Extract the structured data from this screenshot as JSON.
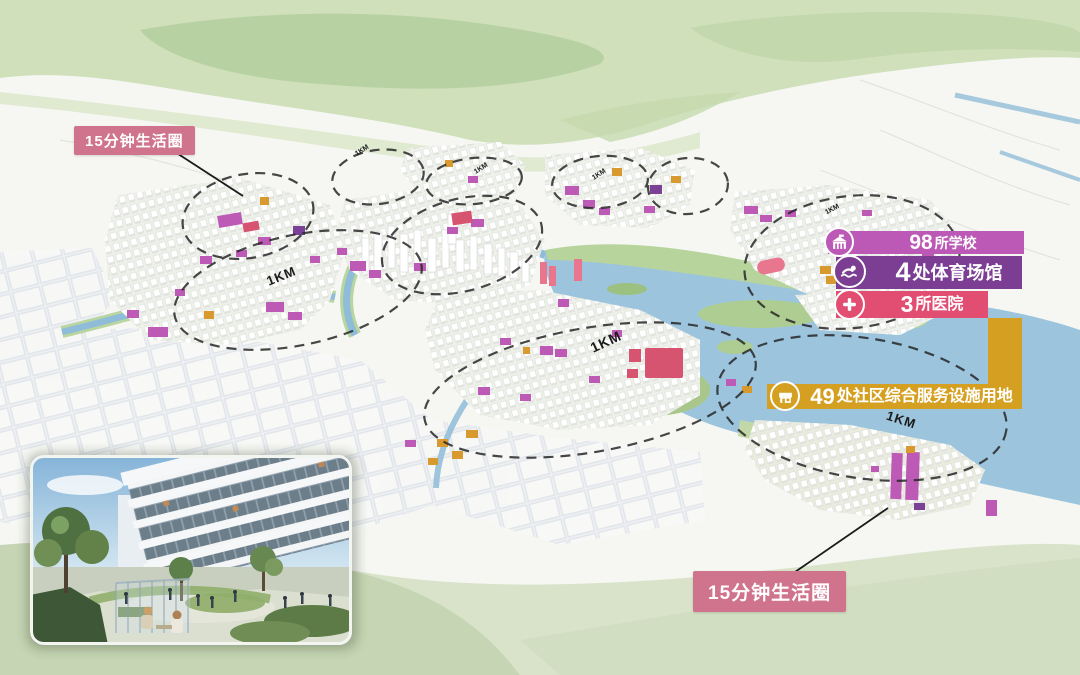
{
  "annotations": {
    "top_left_label": "15分钟生活圈",
    "bottom_right_label": "15分钟生活圈"
  },
  "legend": {
    "items": [
      {
        "icon": "school-icon",
        "number": "98",
        "label": "所学校",
        "color": "#bc58b5"
      },
      {
        "icon": "swimmer-icon",
        "number": "4",
        "label": "处体育场馆",
        "color": "#7b3e92"
      },
      {
        "icon": "hospital-cross-icon",
        "number": "3",
        "label": "所医院",
        "color": "#e14e72"
      },
      {
        "icon": "shop-icon",
        "number": "49",
        "label": "处社区综合服务设施用地",
        "color": "#d5a021"
      }
    ]
  },
  "map": {
    "distance_labels": [
      {
        "text": "1KM",
        "size": "large"
      },
      {
        "text": "1KM",
        "size": "large"
      },
      {
        "text": "1KM",
        "size": "large"
      },
      {
        "text": "1KM",
        "size": "small"
      },
      {
        "text": "1KM",
        "size": "small"
      },
      {
        "text": "1KM",
        "size": "small"
      },
      {
        "text": "1KM",
        "size": "small"
      }
    ]
  },
  "colors": {
    "annotation_pink": "#d0748e",
    "legend_magenta": "#bc58b5",
    "legend_purple": "#7b3e92",
    "legend_pink": "#e14e72",
    "legend_gold": "#d5a021",
    "highlight_magenta": "#bd5ab6",
    "highlight_orange": "#d89a2e",
    "highlight_red": "#d6546f",
    "water_blue": "#9cc5dd",
    "hills_green": "#bcd4a5"
  }
}
